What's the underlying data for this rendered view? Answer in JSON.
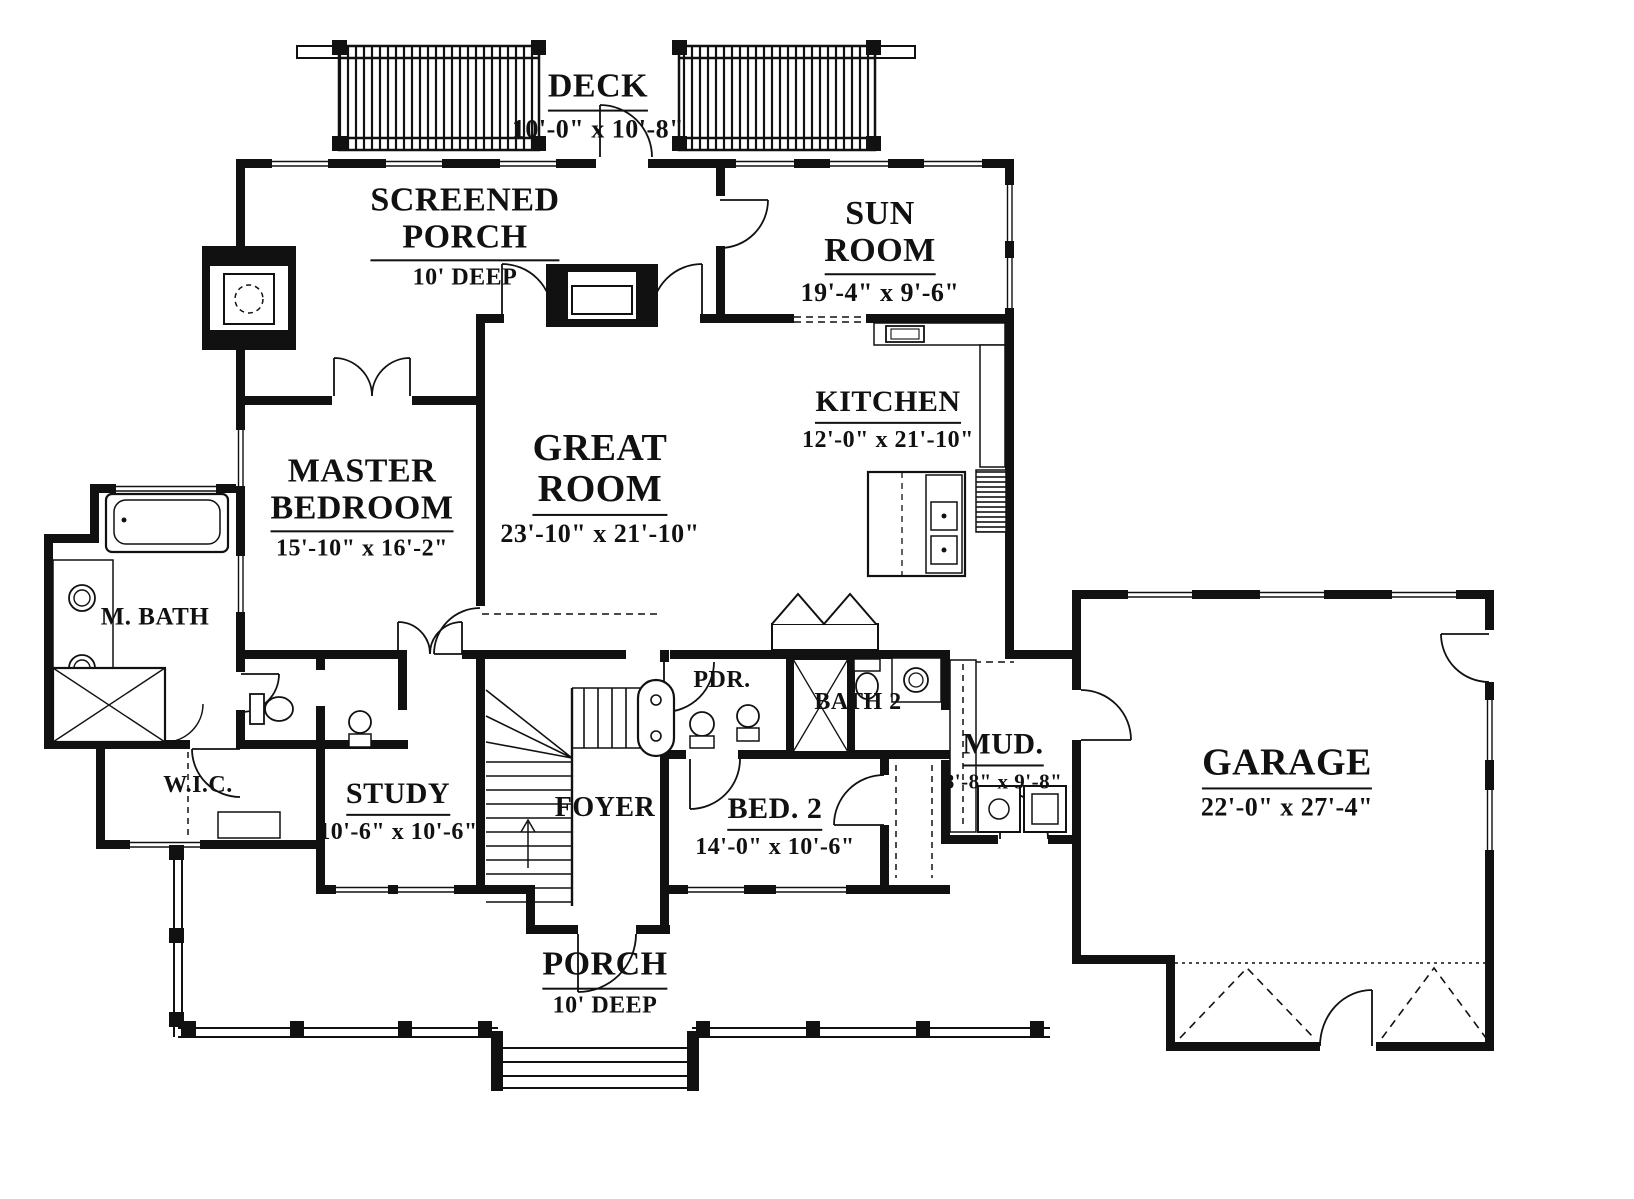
{
  "drawing": {
    "type": "first-floor-plan",
    "ink_color": "#111111",
    "paper_color": "#ffffff"
  },
  "rooms": {
    "deck": {
      "name": "DECK",
      "dims": "10'-0\" x 10'-8\""
    },
    "screened_porch": {
      "name": "SCREENED\nPORCH",
      "dims": "10' DEEP"
    },
    "sun_room": {
      "name": "SUN\nROOM",
      "dims": "19'-4\" x 9'-6\""
    },
    "kitchen": {
      "name": "KITCHEN",
      "dims": "12'-0\" x 21'-10\""
    },
    "great_room": {
      "name": "GREAT\nROOM",
      "dims": "23'-10\" x 21'-10\""
    },
    "master_bedroom": {
      "name": "MASTER\nBEDROOM",
      "dims": "15'-10\" x 16'-2\""
    },
    "m_bath": {
      "name": "M. BATH"
    },
    "wic": {
      "name": "W.I.C."
    },
    "study": {
      "name": "STUDY",
      "dims": "10'-6\" x 10'-6\""
    },
    "foyer": {
      "name": "FOYER"
    },
    "pdr": {
      "name": "PDR."
    },
    "bath2": {
      "name": "BATH 2"
    },
    "bed2": {
      "name": "BED. 2",
      "dims": "14'-0\" x 10'-6\""
    },
    "mud": {
      "name": "MUD.",
      "dims": "8'-8\" x 9'-8\""
    },
    "garage": {
      "name": "GARAGE",
      "dims": "22'-0\" x 27'-4\""
    },
    "porch": {
      "name": "PORCH",
      "dims": "10' DEEP"
    }
  }
}
